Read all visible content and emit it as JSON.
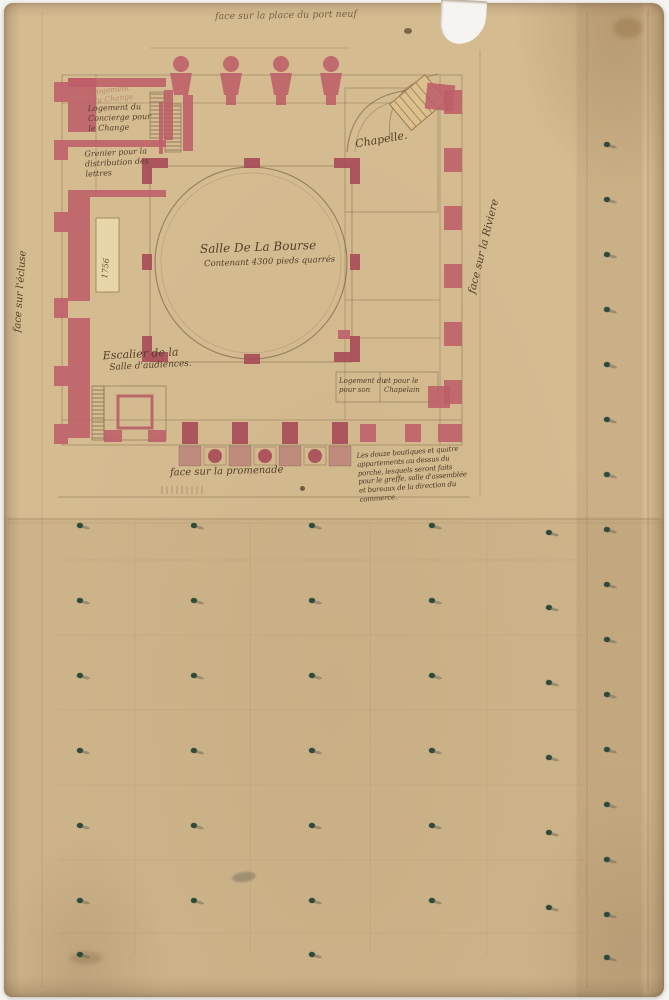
{
  "document": {
    "captions": {
      "top": "face sur la place du port neuf",
      "left": "face sur l'écluse",
      "right": "face sur la Riviere",
      "bottom": "face sur la promenade"
    },
    "rooms": {
      "chapel": "Chapelle.",
      "hall_title": "Salle De La Bourse",
      "hall_subtitle": "Contenant 4300 pieds quarrés",
      "stair_line1": "Escalier de la",
      "stair_line2": "Salle d'audiences.",
      "concierge_faded_line1": "Logement",
      "concierge_faded_line2": "du Change",
      "concierge_line1": "Logement du",
      "concierge_line2": "Concierge pour",
      "concierge_line3": "le Change",
      "grenier_line1": "Grenier pour la",
      "grenier_line2": "distribution des",
      "grenier_line3": "lettres",
      "chaplain_left_line1": "Logement du",
      "chaplain_left_line2": "pour son",
      "chaplain_right_line1": "et pour le",
      "chaplain_right_line2": "Chapelain",
      "date_mark": "1756"
    },
    "note_lines": [
      "Les douze boutiques et quatre",
      "appartements au dessus du",
      "porche, lesquels seront faits",
      "pour le greffe, salle d'assemblée",
      "et bureaux de la direction du",
      "commerce."
    ]
  },
  "colors": {
    "paper": "#d5bb90",
    "wall_pink": "#bd5c68",
    "wall_deep_pink": "#a84a57",
    "pencil_ink": "#6e5b42",
    "hand_ink": "#52402b",
    "stair_tan": "#dcc08e",
    "cream_bar": "#e7d6a9",
    "tree_green": "#2c4a3c"
  },
  "plan": {
    "tree_marks": [
      [
        604,
        142
      ],
      [
        604,
        197
      ],
      [
        604,
        252
      ],
      [
        604,
        307
      ],
      [
        604,
        362
      ],
      [
        604,
        417
      ],
      [
        604,
        472
      ],
      [
        604,
        527
      ],
      [
        604,
        582
      ],
      [
        604,
        637
      ],
      [
        604,
        692
      ],
      [
        604,
        747
      ],
      [
        604,
        802
      ],
      [
        604,
        857
      ],
      [
        604,
        912
      ],
      [
        604,
        955
      ],
      [
        77,
        523
      ],
      [
        77,
        598
      ],
      [
        77,
        673
      ],
      [
        77,
        748
      ],
      [
        77,
        823
      ],
      [
        77,
        898
      ],
      [
        77,
        952
      ],
      [
        191,
        523
      ],
      [
        191,
        598
      ],
      [
        191,
        673
      ],
      [
        191,
        748
      ],
      [
        191,
        823
      ],
      [
        191,
        898
      ],
      [
        309,
        523
      ],
      [
        309,
        598
      ],
      [
        309,
        673
      ],
      [
        309,
        748
      ],
      [
        309,
        823
      ],
      [
        309,
        898
      ],
      [
        309,
        952
      ],
      [
        429,
        523
      ],
      [
        429,
        598
      ],
      [
        429,
        673
      ],
      [
        429,
        748
      ],
      [
        429,
        823
      ],
      [
        429,
        898
      ],
      [
        546,
        530
      ],
      [
        546,
        605
      ],
      [
        546,
        680
      ],
      [
        546,
        755
      ],
      [
        546,
        830
      ],
      [
        546,
        905
      ]
    ]
  }
}
